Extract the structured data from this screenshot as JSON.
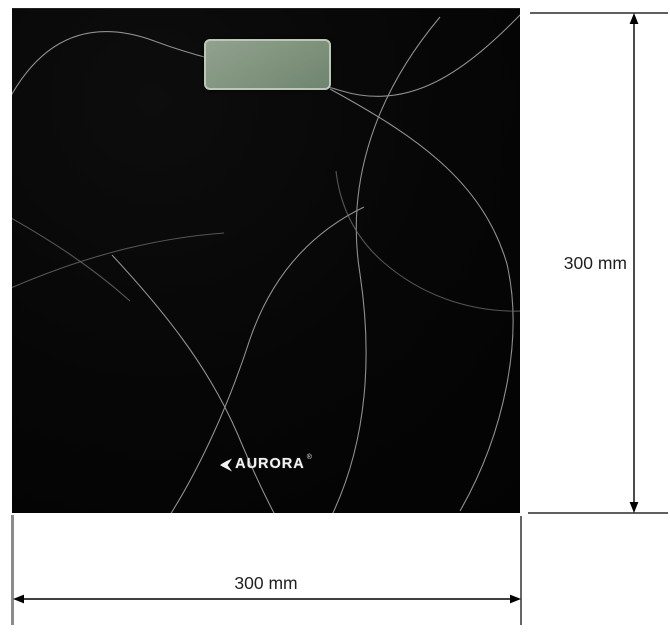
{
  "product": {
    "image": "bathroom-scale-top-view"
  },
  "scale": {
    "brand": "AURORA",
    "registered_mark": "®",
    "display_icon": "lcd-display",
    "swoosh_icon": "brand-left-swoosh"
  },
  "dimensions": {
    "width": {
      "label": "300 mm",
      "value": 300,
      "unit": "mm"
    },
    "height": {
      "label": "300 mm",
      "value": 300,
      "unit": "mm"
    }
  },
  "colors": {
    "background": "#ffffff",
    "scale_body": "#060606",
    "swirl_lines": "#8f8f8d",
    "lcd_face": "#7f937c",
    "lcd_border": "#bcc7b8",
    "brand_text": "#f2f2f2",
    "dimension_lines": "#000000",
    "left_extension_line": "#8c8c8c",
    "label_text": "#1f1f1f"
  }
}
